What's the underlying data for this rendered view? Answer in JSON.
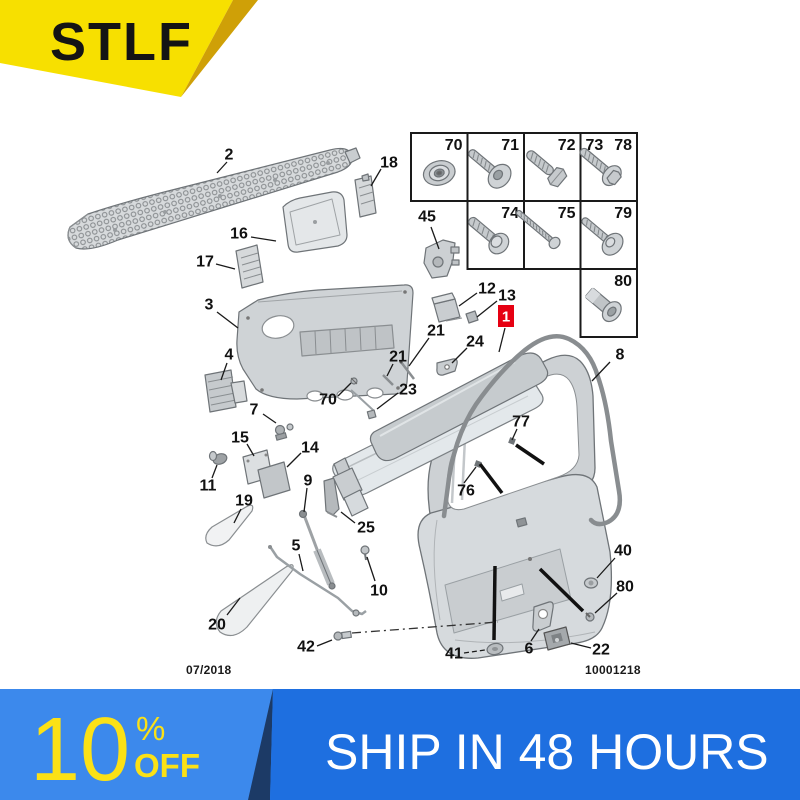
{
  "brand_ribbon": {
    "text": "STLF",
    "bg": "#f7e000",
    "fold": "#cfa007",
    "text_color": "#141414"
  },
  "diagram": {
    "date_code": "07/2018",
    "doc_number": "10001218",
    "badge_color": "#e60012",
    "label_color": "#111111",
    "labels": [
      {
        "n": "2",
        "x": 229,
        "y": 155,
        "leader": [
          227,
          162,
          217,
          173
        ]
      },
      {
        "n": "18",
        "x": 389,
        "y": 163,
        "leader": [
          381,
          169,
          371,
          186
        ]
      },
      {
        "n": "16",
        "x": 239,
        "y": 234,
        "leader": [
          251,
          237,
          276,
          241
        ]
      },
      {
        "n": "17",
        "x": 205,
        "y": 262,
        "leader": [
          216,
          264,
          235,
          269
        ]
      },
      {
        "n": "3",
        "x": 209,
        "y": 305,
        "leader": [
          217,
          312,
          238,
          328
        ]
      },
      {
        "n": "45",
        "x": 427,
        "y": 217,
        "leader": [
          431,
          227,
          439,
          249
        ]
      },
      {
        "n": "12",
        "x": 487,
        "y": 289,
        "leader": [
          477,
          293,
          459,
          306
        ]
      },
      {
        "n": "13",
        "x": 507,
        "y": 296,
        "leader": [
          497,
          301,
          477,
          317
        ]
      },
      {
        "n": "1",
        "x": 506,
        "y": 316,
        "red": true,
        "leader": [
          505,
          328,
          499,
          352
        ]
      },
      {
        "n": "21",
        "x": 436,
        "y": 331,
        "leader": [
          429,
          338,
          409,
          366
        ]
      },
      {
        "n": "24",
        "x": 475,
        "y": 342,
        "leader": [
          467,
          348,
          452,
          363
        ]
      },
      {
        "n": "21",
        "x": 398,
        "y": 357,
        "leader": [
          393,
          364,
          387,
          376
        ]
      },
      {
        "n": "70",
        "x": 328,
        "y": 400,
        "leader": [
          338,
          396,
          351,
          383
        ]
      },
      {
        "n": "23",
        "x": 408,
        "y": 390,
        "leader": [
          398,
          393,
          377,
          409
        ]
      },
      {
        "n": "4",
        "x": 229,
        "y": 355,
        "leader": [
          227,
          363,
          221,
          380
        ]
      },
      {
        "n": "7",
        "x": 254,
        "y": 410,
        "leader": [
          263,
          414,
          276,
          423
        ]
      },
      {
        "n": "15",
        "x": 240,
        "y": 438,
        "leader": [
          247,
          444,
          254,
          456
        ]
      },
      {
        "n": "14",
        "x": 310,
        "y": 448,
        "leader": [
          301,
          453,
          287,
          467
        ]
      },
      {
        "n": "11",
        "x": 208,
        "y": 486,
        "leader": [
          212,
          478,
          217,
          465
        ]
      },
      {
        "n": "19",
        "x": 244,
        "y": 501,
        "leader": [
          241,
          509,
          234,
          523
        ]
      },
      {
        "n": "9",
        "x": 308,
        "y": 481,
        "leader": [
          307,
          488,
          304,
          512
        ]
      },
      {
        "n": "25",
        "x": 366,
        "y": 528,
        "leader": [
          355,
          523,
          341,
          512
        ]
      },
      {
        "n": "5",
        "x": 296,
        "y": 546,
        "leader": [
          299,
          554,
          303,
          571
        ]
      },
      {
        "n": "10",
        "x": 379,
        "y": 591,
        "leader": [
          375,
          581,
          367,
          557
        ]
      },
      {
        "n": "20",
        "x": 217,
        "y": 625,
        "leader": [
          227,
          615,
          240,
          598
        ]
      },
      {
        "n": "42",
        "x": 306,
        "y": 647,
        "leader": [
          317,
          646,
          332,
          640
        ]
      },
      {
        "n": "41",
        "x": 454,
        "y": 654,
        "dash": true,
        "leader": [
          464,
          653,
          485,
          650
        ]
      },
      {
        "n": "6",
        "x": 529,
        "y": 649,
        "leader": [
          531,
          641,
          539,
          629
        ]
      },
      {
        "n": "22",
        "x": 601,
        "y": 650,
        "leader": [
          591,
          648,
          571,
          643
        ]
      },
      {
        "n": "40",
        "x": 623,
        "y": 551,
        "leader": [
          615,
          558,
          597,
          578
        ]
      },
      {
        "n": "80",
        "x": 625,
        "y": 587,
        "leader": [
          617,
          593,
          595,
          613
        ]
      },
      {
        "n": "76",
        "x": 466,
        "y": 491,
        "leader": [
          464,
          483,
          476,
          467
        ]
      },
      {
        "n": "77",
        "x": 521,
        "y": 422,
        "leader": [
          517,
          429,
          512,
          440
        ]
      },
      {
        "n": "8",
        "x": 620,
        "y": 355,
        "leader": [
          610,
          362,
          592,
          381
        ]
      }
    ],
    "indicator_lines": [
      [
        516,
        445,
        544,
        464
      ],
      [
        480,
        464,
        502,
        493
      ],
      [
        495,
        566,
        494,
        640
      ],
      [
        540,
        569,
        583,
        611
      ]
    ],
    "dashdot_lines": [
      [
        352,
        633,
        498,
        622
      ]
    ],
    "fastener_table": {
      "x": 411,
      "y": 133,
      "cell_w": 56.5,
      "cell_h": 68,
      "cells": [
        {
          "r": 0,
          "c": 0,
          "nums": [
            {
              "t": "70",
              "align": "right"
            }
          ],
          "type": "nut"
        },
        {
          "r": 0,
          "c": 1,
          "nums": [
            {
              "t": "71",
              "align": "right"
            }
          ],
          "type": "washerbolt"
        },
        {
          "r": 0,
          "c": 2,
          "nums": [
            {
              "t": "72",
              "align": "right"
            }
          ],
          "type": "hexbolt"
        },
        {
          "r": 0,
          "c": 3,
          "nums": [
            {
              "t": "73",
              "align": "left"
            },
            {
              "t": "78",
              "align": "right"
            }
          ],
          "type": "hexwasher"
        },
        {
          "r": 1,
          "c": 1,
          "nums": [
            {
              "t": "74",
              "align": "right"
            }
          ],
          "type": "washerscrew"
        },
        {
          "r": 1,
          "c": 2,
          "nums": [
            {
              "t": "75",
              "align": "right"
            }
          ],
          "type": "longscrew"
        },
        {
          "r": 1,
          "c": 3,
          "nums": [
            {
              "t": "79",
              "align": "right"
            }
          ],
          "type": "bigwasher"
        },
        {
          "r": 2,
          "c": 3,
          "nums": [
            {
              "t": "80",
              "align": "right"
            }
          ],
          "type": "rivet"
        }
      ]
    }
  },
  "promo_banner": {
    "discount_value": "10",
    "percent_sign": "%",
    "off_label": "OFF",
    "shipping_text": "SHIP IN 48 HOURS",
    "left_bg": "#3c89ec",
    "right_bg": "#1e6fe0",
    "wedge_color": "#1c3a66",
    "accent": "#fbe116",
    "shipping_text_color": "#ffffff"
  }
}
